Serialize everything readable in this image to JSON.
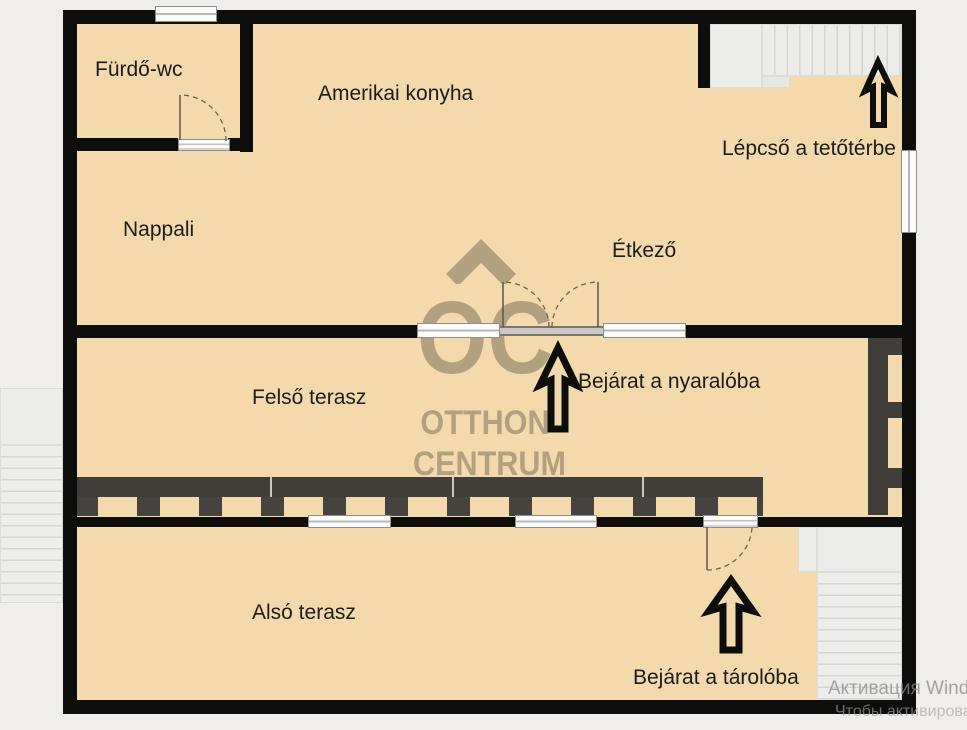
{
  "plan": {
    "rooms": {
      "furdo_wc": "Fürdő-wc",
      "amerikai_konyha": "Amerikai konyha",
      "nappali": "Nappali",
      "etkezo": "Étkező",
      "felso_terasz": "Felső terasz",
      "also_terasz": "Alsó terasz"
    },
    "annotations": {
      "lepcso_tetoterbe": "Lépcső a tetőtérbe",
      "bejarat_nyaraloba": "Bejárat a nyaralóba",
      "bejarat_taroloba": "Bejárat a tárolóba"
    }
  },
  "watermarks": {
    "agency_logo": {
      "monogram": "OC",
      "line1": "OTTHON",
      "line2": "CENTRUM"
    },
    "os_activation": {
      "line1": "Активация Windows",
      "line2": "Чтобы активировать"
    }
  },
  "colors": {
    "floor": "#F3D9AC",
    "walls": "#0D0D0B",
    "background": "#EFEEEA",
    "railing": "#44413D",
    "stairs": "#ECECEA",
    "logo_watermark": "#6F6650",
    "label_text": "#1C1C1A"
  }
}
